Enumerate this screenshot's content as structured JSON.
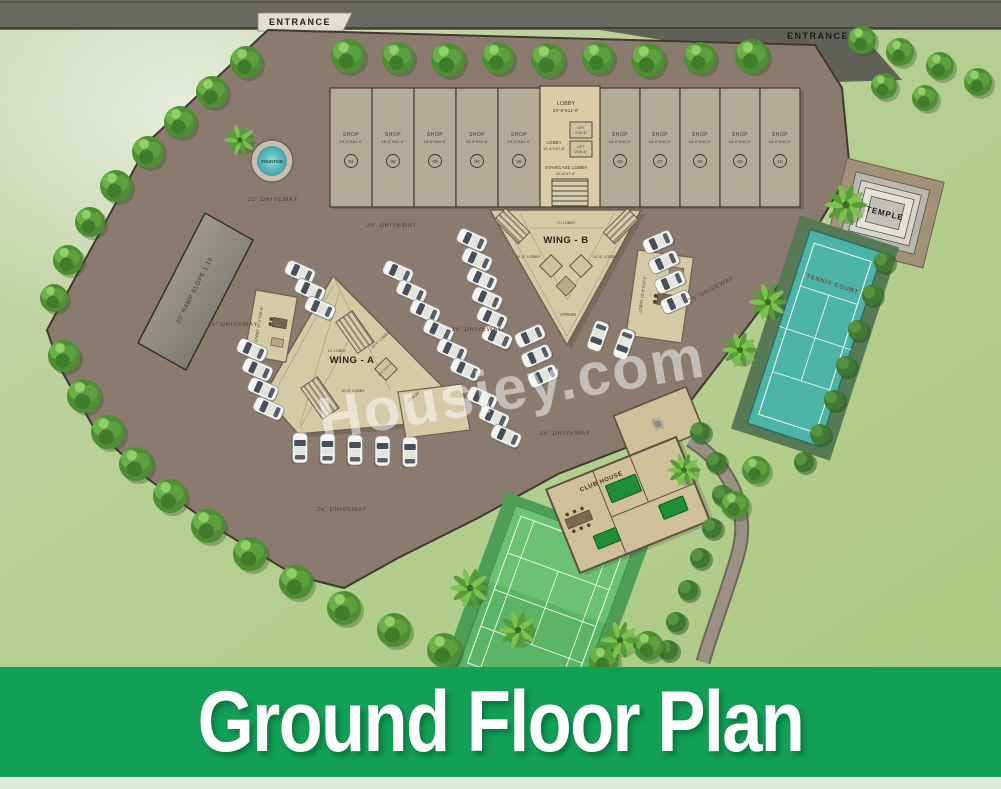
{
  "banner": {
    "title": "Ground Floor Plan",
    "bg_color": "#12a057"
  },
  "watermark": "Housiey.com",
  "entrances": {
    "left": "ENTRANCE",
    "right": "ENTRANCE"
  },
  "shops": {
    "label": "SHOP",
    "size": "15'-0\"X40'-0\"",
    "numbers": [
      "01",
      "02",
      "03",
      "04",
      "05",
      "06",
      "07",
      "08",
      "09",
      "10"
    ]
  },
  "core": {
    "lobby_top": "LOBBY",
    "lobby_top_size": "20'-6\"X11'-0\"",
    "lift_label": "LIFT",
    "lift_size": "8'X6'-6\"",
    "lobby_mid": "LOBBY",
    "lobby_mid_size": "12'-4\"X10'-6\"",
    "staircase_lobby": "STAIRCASE LOBBY",
    "staircase_lobby_size": "20'-6\"X7'-4\""
  },
  "wing_b": {
    "name": "WING - B",
    "to_lobby": "TO LOBBY",
    "lobby_left": "10'-6\" LOBBY",
    "lobby_right": "10'-6\" LOBBY",
    "atrium": "ATRIUM",
    "side_lobby": "LOBBY 12'-4\"X20'-6\""
  },
  "wing_a": {
    "name": "WING - A",
    "lobby1": "10' LOBBY",
    "lobby2": "10'-6\" LOBBY",
    "lobby3": "10'-6\" LOBBY",
    "lift": "LIFT 8'X6'-6\"",
    "atrium": "ATRIUM",
    "side_lobby": "LOBBY 12'-4\"X20'-6\""
  },
  "site": {
    "driveway": "25' DRIVEWAY",
    "ramp": "20' RAMP SLOPE 1:10",
    "fountain": "FOUNTAIN",
    "temple": "TEMPLE",
    "tennis_court": "TENNIS COURT",
    "club_house": "CLUB HOUSE"
  },
  "icons": {
    "tree": "tree-icon",
    "palm": "palm-icon",
    "car": "car-icon",
    "bush": "bush-icon"
  },
  "colors": {
    "banner_green": "#12a057",
    "paving": "#8a7b6e",
    "grass": "#b6cf92",
    "road": "#6a6a62",
    "building": "#d8cba6",
    "shop": "#b4ab96",
    "teal_court": "#4cb3a7",
    "green_court": "#5cb566",
    "water": "#63c4c6"
  }
}
